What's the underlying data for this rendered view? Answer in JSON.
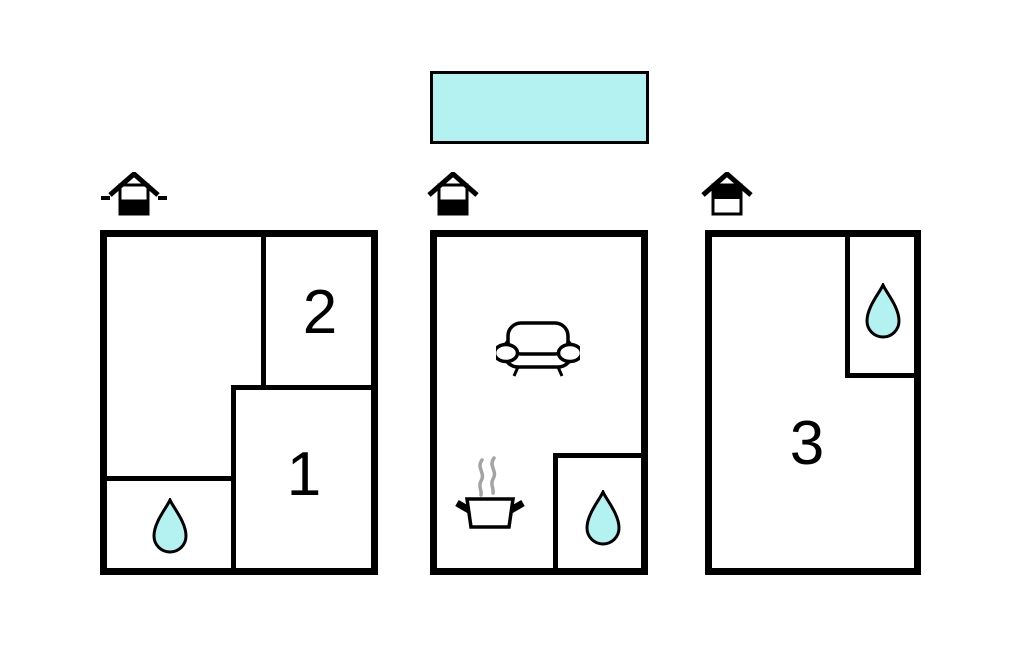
{
  "canvas": {
    "width": 1024,
    "height": 652,
    "background": "#ffffff"
  },
  "palette": {
    "outline": "#000000",
    "water_cyan": "#b4f1f1",
    "steam_gray": "#a3a3a3"
  },
  "legend_bar": {
    "shape": "rectangle",
    "fill": "#b4f1f1",
    "label": ""
  },
  "plans": [
    {
      "name": "floor-plan-1",
      "level_icon": {
        "type": "house-level-icon",
        "filled_half": "bottom",
        "side_dashes": true
      },
      "rooms": [
        {
          "label": "2"
        },
        {
          "label": "1"
        }
      ],
      "features": [
        "water-drop"
      ]
    },
    {
      "name": "floor-plan-2",
      "level_icon": {
        "type": "house-level-icon",
        "filled_half": "bottom",
        "side_dashes": false
      },
      "rooms": [],
      "features": [
        "sofa",
        "cooking-pot",
        "water-drop"
      ]
    },
    {
      "name": "floor-plan-3",
      "level_icon": {
        "type": "house-level-icon",
        "filled_half": "top",
        "side_dashes": false
      },
      "rooms": [
        {
          "label": "3"
        }
      ],
      "features": [
        "water-drop"
      ]
    }
  ]
}
